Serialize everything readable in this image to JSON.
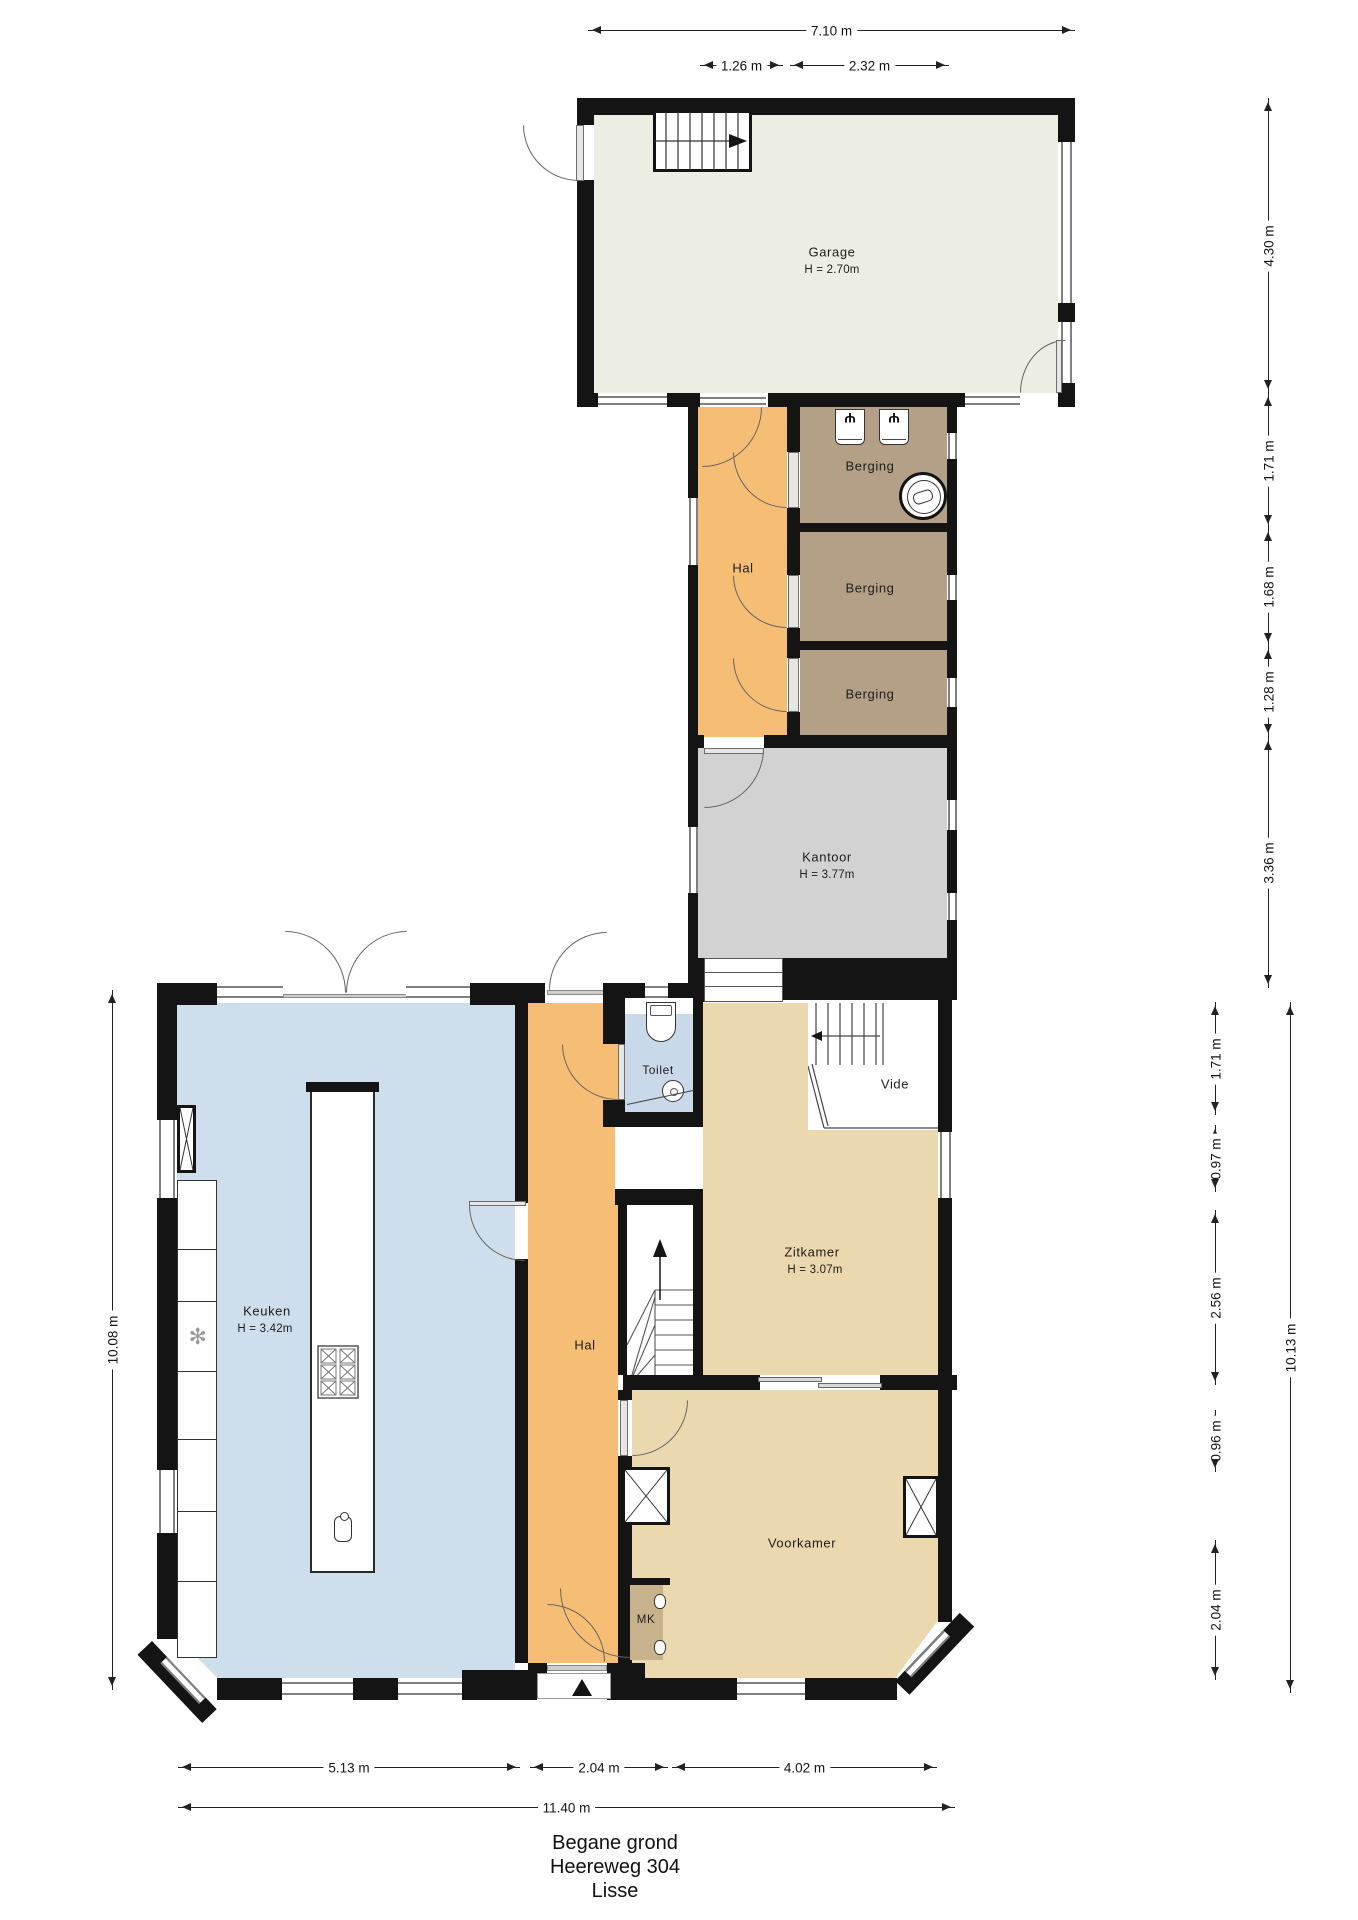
{
  "title": {
    "lines": [
      "Begane grond",
      "Heereweg 304",
      "Lisse"
    ]
  },
  "rooms": {
    "garage": {
      "name": "Garage",
      "height": "H = 2.70m"
    },
    "hal_boven": {
      "name": "Hal"
    },
    "berging_1": {
      "name": "Berging"
    },
    "berging_2": {
      "name": "Berging"
    },
    "berging_3": {
      "name": "Berging"
    },
    "kantoor": {
      "name": "Kantoor",
      "height": "H = 3.77m"
    },
    "keuken": {
      "name": "Keuken",
      "height": "H = 3.42m"
    },
    "hal_beneden": {
      "name": "Hal"
    },
    "toilet": {
      "name": "Toilet"
    },
    "vide": {
      "name": "Vide"
    },
    "zitkamer": {
      "name": "Zitkamer",
      "height": "H = 3.07m"
    },
    "voorkamer": {
      "name": "Voorkamer"
    },
    "mk": {
      "name": "MK"
    }
  },
  "dimensions": {
    "top_total": "7.10 m",
    "top_hal": "1.26 m",
    "top_berging": "2.32 m",
    "right_garage": "4.30 m",
    "right_berging1": "1.71 m",
    "right_berging2": "1.68 m",
    "right_berging3": "1.28 m",
    "right_kantoor": "3.36 m",
    "right_zit1": "1.71 m",
    "right_zit2": "0.97 m",
    "right_zit3": "2.56 m",
    "right_zit4": "0.96 m",
    "right_zit5": "2.04 m",
    "right_total": "10.13 m",
    "left_total": "10.08 m",
    "bottom_keuken": "5.13 m",
    "bottom_hal": "2.04 m",
    "bottom_voorkamer": "4.02 m",
    "bottom_total": "11.40 m"
  },
  "colors": {
    "wall": "#141414",
    "garage": "#EDEEE3",
    "hal": "#F6BE75",
    "berging": "#B3A086",
    "kantoor": "#D2D2D2",
    "keuken": "#CFDEEC",
    "toilet": "#C9D9EA",
    "zitkamer": "#ECD8AE",
    "mk": "#C8B28C"
  },
  "icons": {
    "tap": "Ψ",
    "snowflake": "✻",
    "slide_left": "←",
    "slide_right": "→"
  }
}
